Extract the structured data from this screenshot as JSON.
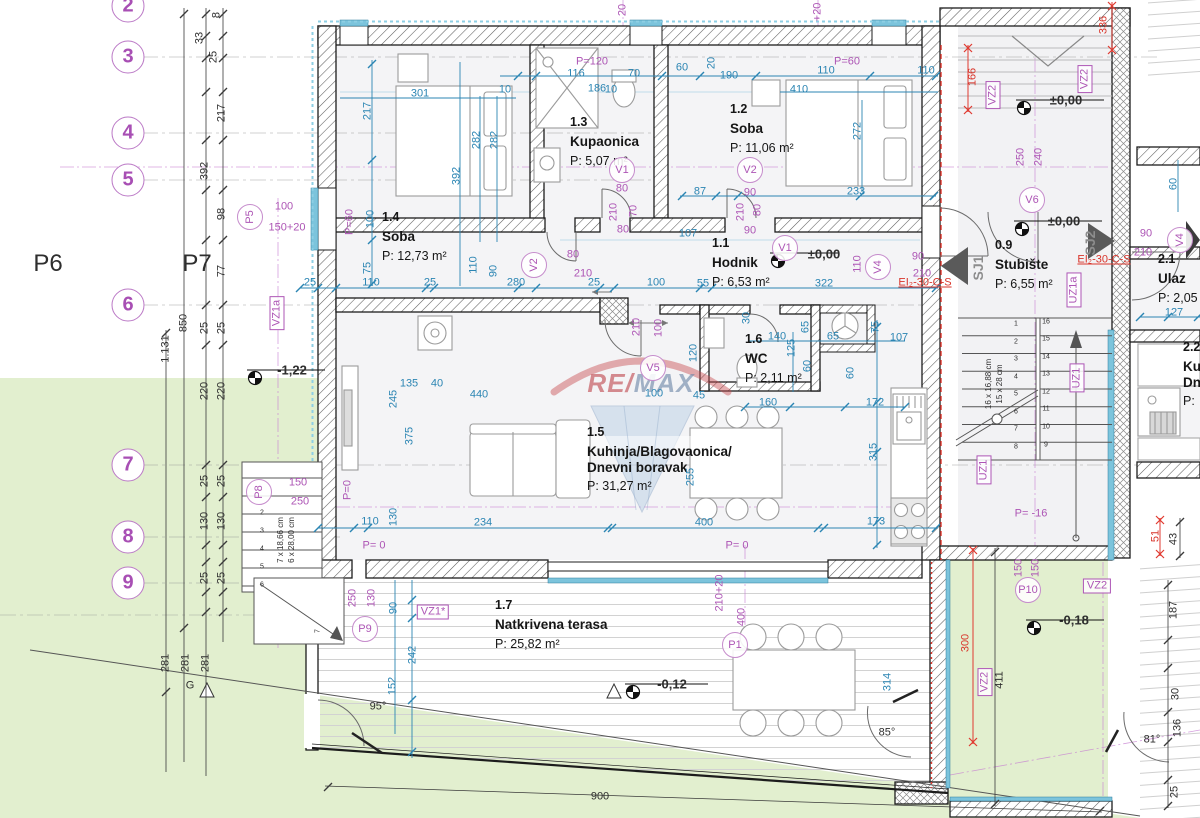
{
  "watermark": {
    "re": "RE",
    "slash": "/",
    "max": "MAX"
  },
  "grid": {
    "rows": [
      {
        "n": "2",
        "y": 6
      },
      {
        "n": "3",
        "y": 57
      },
      {
        "n": "4",
        "y": 133
      },
      {
        "n": "5",
        "y": 180
      },
      {
        "n": "6",
        "y": 305
      },
      {
        "n": "7",
        "y": 465
      },
      {
        "n": "8",
        "y": 537
      },
      {
        "n": "9",
        "y": 583
      }
    ],
    "plan_labels": [
      {
        "t": "P6",
        "x": 48,
        "y": 264
      },
      {
        "t": "P7",
        "x": 197,
        "y": 264
      }
    ]
  },
  "rooms": [
    {
      "id": "1.4",
      "lines": [
        "Soba"
      ],
      "area": "P: 12,73 m²",
      "x": 382,
      "y": 210
    },
    {
      "id": "1.3",
      "lines": [
        "Kupaonica"
      ],
      "area": "P: 5,07 m²",
      "x": 570,
      "y": 115
    },
    {
      "id": "1.2",
      "lines": [
        "Soba"
      ],
      "area": "P: 11,06 m²",
      "x": 730,
      "y": 102
    },
    {
      "id": "1.1",
      "lines": [
        "Hodnik"
      ],
      "area": "P: 6,53 m²",
      "x": 712,
      "y": 236
    },
    {
      "id": "1.6",
      "lines": [
        "WC"
      ],
      "area": "P: 2,11 m²",
      "x": 745,
      "y": 332
    },
    {
      "id": "1.5",
      "lines": [
        "Kuhinja/Blagovaonica/",
        "Dnevni boravak"
      ],
      "area": "P: 31,27 m²",
      "x": 587,
      "y": 425
    },
    {
      "id": "1.7",
      "lines": [
        "Natkrivena terasa"
      ],
      "area": "P: 25,82 m²",
      "x": 495,
      "y": 598
    },
    {
      "id": "0.9",
      "lines": [
        "Stubište"
      ],
      "area": "P: 6,55 m²",
      "x": 995,
      "y": 238
    },
    {
      "id": "2.1",
      "lines": [
        "Ulaz"
      ],
      "area": "P: 2,05",
      "x": 1158,
      "y": 252
    },
    {
      "id": "2.2",
      "lines": [
        "Ku",
        "Dn"
      ],
      "area": "P:",
      "x": 1183,
      "y": 340
    }
  ],
  "levels": [
    {
      "t": "±0,00",
      "x": 824,
      "y": 254
    },
    {
      "t": "±0,00",
      "x": 1066,
      "y": 100
    },
    {
      "t": "±0,00",
      "x": 1064,
      "y": 221
    },
    {
      "t": "-1,22",
      "x": 292,
      "y": 370
    },
    {
      "t": "-0,12",
      "x": 672,
      "y": 684
    },
    {
      "t": "-0,18",
      "x": 1074,
      "y": 620
    }
  ],
  "annotations": [
    {
      "t": "301",
      "x": 420,
      "y": 94
    },
    {
      "t": "217",
      "x": 368,
      "y": 111,
      "v": 1
    },
    {
      "t": "282",
      "x": 477,
      "y": 140,
      "v": 1
    },
    {
      "t": "282",
      "x": 495,
      "y": 140,
      "v": 1
    },
    {
      "t": "392",
      "x": 457,
      "y": 176,
      "v": 1
    },
    {
      "t": "100",
      "x": 371,
      "y": 219,
      "v": 1
    },
    {
      "t": "75",
      "x": 368,
      "y": 268,
      "v": 1
    },
    {
      "t": "110",
      "x": 474,
      "y": 265,
      "v": 1
    },
    {
      "t": "90",
      "x": 494,
      "y": 271,
      "v": 1
    },
    {
      "t": "116",
      "x": 576,
      "y": 74
    },
    {
      "t": "186",
      "x": 597,
      "y": 89
    },
    {
      "t": "70",
      "x": 634,
      "y": 74
    },
    {
      "t": "10",
      "x": 505,
      "y": 90
    },
    {
      "t": "10",
      "x": 611,
      "y": 90
    },
    {
      "t": "60",
      "x": 682,
      "y": 68
    },
    {
      "t": "20",
      "x": 712,
      "y": 63,
      "v": 1
    },
    {
      "t": "190",
      "x": 729,
      "y": 76
    },
    {
      "t": "110",
      "x": 826,
      "y": 71
    },
    {
      "t": "110",
      "x": 926,
      "y": 71
    },
    {
      "t": "410",
      "x": 799,
      "y": 90
    },
    {
      "t": "272",
      "x": 858,
      "y": 131,
      "v": 1
    },
    {
      "t": "233",
      "x": 856,
      "y": 192
    },
    {
      "t": "87",
      "x": 700,
      "y": 192
    },
    {
      "t": "107",
      "x": 688,
      "y": 234
    },
    {
      "t": "25",
      "x": 310,
      "y": 283
    },
    {
      "t": "110",
      "x": 371,
      "y": 283
    },
    {
      "t": "25",
      "x": 430,
      "y": 283
    },
    {
      "t": "280",
      "x": 516,
      "y": 283
    },
    {
      "t": "25",
      "x": 594,
      "y": 283
    },
    {
      "t": "100",
      "x": 656,
      "y": 283
    },
    {
      "t": "55",
      "x": 703,
      "y": 284
    },
    {
      "t": "322",
      "x": 824,
      "y": 284
    },
    {
      "t": "30",
      "x": 747,
      "y": 318,
      "v": 1
    },
    {
      "t": "140",
      "x": 777,
      "y": 337
    },
    {
      "t": "65",
      "x": 806,
      "y": 327,
      "v": 1
    },
    {
      "t": "65",
      "x": 833,
      "y": 337
    },
    {
      "t": "125",
      "x": 792,
      "y": 348,
      "v": 1
    },
    {
      "t": "60",
      "x": 808,
      "y": 366,
      "v": 1
    },
    {
      "t": "60",
      "x": 851,
      "y": 373,
      "v": 1
    },
    {
      "t": "120",
      "x": 694,
      "y": 353,
      "v": 1
    },
    {
      "t": "160",
      "x": 768,
      "y": 403
    },
    {
      "t": "172",
      "x": 875,
      "y": 403
    },
    {
      "t": "107",
      "x": 899,
      "y": 338
    },
    {
      "t": "75",
      "x": 876,
      "y": 327,
      "v": 1
    },
    {
      "t": "100",
      "x": 654,
      "y": 394
    },
    {
      "t": "45",
      "x": 699,
      "y": 396
    },
    {
      "t": "135",
      "x": 409,
      "y": 384
    },
    {
      "t": "40",
      "x": 437,
      "y": 384
    },
    {
      "t": "440",
      "x": 479,
      "y": 395
    },
    {
      "t": "245",
      "x": 394,
      "y": 399,
      "v": 1
    },
    {
      "t": "375",
      "x": 410,
      "y": 436,
      "v": 1
    },
    {
      "t": "110",
      "x": 370,
      "y": 522
    },
    {
      "t": "130",
      "x": 394,
      "y": 517,
      "v": 1
    },
    {
      "t": "234",
      "x": 483,
      "y": 523
    },
    {
      "t": "400",
      "x": 704,
      "y": 523
    },
    {
      "t": "173",
      "x": 876,
      "y": 522
    },
    {
      "t": "315",
      "x": 874,
      "y": 452,
      "v": 1
    },
    {
      "t": "255",
      "x": 691,
      "y": 477,
      "v": 1
    },
    {
      "t": "314",
      "x": 888,
      "y": 682,
      "v": 1
    },
    {
      "t": "90",
      "x": 394,
      "y": 608,
      "v": 1
    },
    {
      "t": "242",
      "x": 413,
      "y": 655,
      "v": 1
    },
    {
      "t": "152",
      "x": 393,
      "y": 686,
      "v": 1
    },
    {
      "t": "127",
      "x": 1174,
      "y": 313
    },
    {
      "t": "60",
      "x": 1174,
      "y": 184,
      "v": 1
    },
    {
      "t": "8",
      "x": 217,
      "y": 15,
      "v": 1,
      "c": "k"
    },
    {
      "t": "33",
      "x": 200,
      "y": 38,
      "v": 1,
      "c": "k"
    },
    {
      "t": "25",
      "x": 214,
      "y": 57,
      "v": 1,
      "c": "k"
    },
    {
      "t": "217",
      "x": 222,
      "y": 113,
      "v": 1,
      "c": "k"
    },
    {
      "t": "392",
      "x": 205,
      "y": 171,
      "v": 1,
      "c": "k"
    },
    {
      "t": "98",
      "x": 222,
      "y": 214,
      "v": 1,
      "c": "k"
    },
    {
      "t": "77",
      "x": 222,
      "y": 271,
      "v": 1,
      "c": "k"
    },
    {
      "t": "850",
      "x": 184,
      "y": 323,
      "v": 1,
      "c": "k"
    },
    {
      "t": "1.131",
      "x": 166,
      "y": 349,
      "v": 1,
      "c": "k"
    },
    {
      "t": "25",
      "x": 205,
      "y": 328,
      "v": 1,
      "c": "k"
    },
    {
      "t": "25",
      "x": 222,
      "y": 328,
      "v": 1,
      "c": "k"
    },
    {
      "t": "220",
      "x": 205,
      "y": 391,
      "v": 1,
      "c": "k"
    },
    {
      "t": "220",
      "x": 222,
      "y": 391,
      "v": 1,
      "c": "k"
    },
    {
      "t": "25",
      "x": 205,
      "y": 481,
      "v": 1,
      "c": "k"
    },
    {
      "t": "25",
      "x": 222,
      "y": 481,
      "v": 1,
      "c": "k"
    },
    {
      "t": "130",
      "x": 205,
      "y": 521,
      "v": 1,
      "c": "k"
    },
    {
      "t": "130",
      "x": 222,
      "y": 521,
      "v": 1,
      "c": "k"
    },
    {
      "t": "25",
      "x": 205,
      "y": 578,
      "v": 1,
      "c": "k"
    },
    {
      "t": "25",
      "x": 222,
      "y": 578,
      "v": 1,
      "c": "k"
    },
    {
      "t": "281",
      "x": 166,
      "y": 663,
      "v": 1,
      "c": "k"
    },
    {
      "t": "281",
      "x": 186,
      "y": 663,
      "v": 1,
      "c": "k"
    },
    {
      "t": "281",
      "x": 206,
      "y": 663,
      "v": 1,
      "c": "k"
    },
    {
      "t": "G",
      "x": 190,
      "y": 686,
      "c": "k"
    },
    {
      "t": "900",
      "x": 600,
      "y": 797,
      "c": "k"
    },
    {
      "t": "43",
      "x": 1174,
      "y": 539,
      "v": 1,
      "c": "k"
    },
    {
      "t": "411",
      "x": 1000,
      "y": 680,
      "v": 1,
      "c": "k"
    },
    {
      "t": "187",
      "x": 1174,
      "y": 610,
      "v": 1,
      "c": "k"
    },
    {
      "t": "30",
      "x": 1176,
      "y": 694,
      "v": 1,
      "c": "k"
    },
    {
      "t": "136",
      "x": 1178,
      "y": 728,
      "v": 1,
      "c": "k"
    },
    {
      "t": "25",
      "x": 1175,
      "y": 792,
      "v": 1,
      "c": "k"
    },
    {
      "t": "95°",
      "x": 378,
      "y": 707,
      "c": "k"
    },
    {
      "t": "85°",
      "x": 887,
      "y": 733,
      "c": "k"
    },
    {
      "t": "81°",
      "x": 1152,
      "y": 740,
      "c": "k"
    },
    {
      "t": "16 x 16,88 cm",
      "x": 989,
      "y": 384,
      "v": 1,
      "c": "k",
      "fs": 8
    },
    {
      "t": "15 x 28 cm",
      "x": 1000,
      "y": 384,
      "v": 1,
      "c": "k",
      "fs": 8
    },
    {
      "t": "7 x 18,66 cm",
      "x": 281,
      "y": 540,
      "v": 1,
      "c": "k",
      "fs": 8
    },
    {
      "t": "6 x 28,00 cm",
      "x": 292,
      "y": 540,
      "v": 1,
      "c": "k",
      "fs": 8
    },
    {
      "t": "1",
      "x": 1016,
      "y": 324,
      "c": "k",
      "fs": 7
    },
    {
      "t": "2",
      "x": 1016,
      "y": 342,
      "c": "k",
      "fs": 7
    },
    {
      "t": "3",
      "x": 1016,
      "y": 359,
      "c": "k",
      "fs": 7
    },
    {
      "t": "4",
      "x": 1016,
      "y": 377,
      "c": "k",
      "fs": 7
    },
    {
      "t": "5",
      "x": 1016,
      "y": 394,
      "c": "k",
      "fs": 7
    },
    {
      "t": "6",
      "x": 1016,
      "y": 412,
      "c": "k",
      "fs": 7
    },
    {
      "t": "7",
      "x": 1016,
      "y": 429,
      "c": "k",
      "fs": 7
    },
    {
      "t": "8",
      "x": 1016,
      "y": 447,
      "c": "k",
      "fs": 7
    },
    {
      "t": "16",
      "x": 1046,
      "y": 322,
      "c": "k",
      "fs": 7
    },
    {
      "t": "15",
      "x": 1046,
      "y": 339,
      "c": "k",
      "fs": 7
    },
    {
      "t": "14",
      "x": 1046,
      "y": 357,
      "c": "k",
      "fs": 7
    },
    {
      "t": "13",
      "x": 1046,
      "y": 374,
      "c": "k",
      "fs": 7
    },
    {
      "t": "12",
      "x": 1046,
      "y": 392,
      "c": "k",
      "fs": 7
    },
    {
      "t": "11",
      "x": 1046,
      "y": 409,
      "c": "k",
      "fs": 7
    },
    {
      "t": "10",
      "x": 1046,
      "y": 427,
      "c": "k",
      "fs": 7
    },
    {
      "t": "9",
      "x": 1046,
      "y": 445,
      "c": "k",
      "fs": 7
    },
    {
      "t": "2",
      "x": 262,
      "y": 513,
      "c": "k",
      "fs": 7
    },
    {
      "t": "3",
      "x": 262,
      "y": 531,
      "c": "k",
      "fs": 7
    },
    {
      "t": "4",
      "x": 262,
      "y": 549,
      "c": "k",
      "fs": 7
    },
    {
      "t": "5",
      "x": 262,
      "y": 567,
      "c": "k",
      "fs": 7
    },
    {
      "t": "6",
      "x": 262,
      "y": 585,
      "c": "k",
      "fs": 7
    },
    {
      "t": "7",
      "x": 318,
      "y": 631,
      "v": 1,
      "c": "k",
      "fs": 7
    },
    {
      "t": "P=120",
      "x": 592,
      "y": 62,
      "c": "p"
    },
    {
      "t": "P=60",
      "x": 847,
      "y": 62,
      "c": "p"
    },
    {
      "t": "P=60",
      "x": 350,
      "y": 222,
      "c": "p",
      "v": 1
    },
    {
      "t": "P=0",
      "x": 348,
      "y": 490,
      "c": "p",
      "v": 1
    },
    {
      "t": "P= 0",
      "x": 374,
      "y": 546,
      "c": "p"
    },
    {
      "t": "P= 0",
      "x": 737,
      "y": 546,
      "c": "p"
    },
    {
      "t": "P= -16",
      "x": 1031,
      "y": 514,
      "c": "p"
    },
    {
      "t": "100",
      "x": 284,
      "y": 207,
      "c": "p"
    },
    {
      "t": "150+20",
      "x": 287,
      "y": 228,
      "c": "p"
    },
    {
      "t": "150",
      "x": 298,
      "y": 483,
      "c": "p"
    },
    {
      "t": "250",
      "x": 300,
      "y": 502,
      "c": "p"
    },
    {
      "t": "250",
      "x": 353,
      "y": 598,
      "c": "p",
      "v": 1
    },
    {
      "t": "130",
      "x": 372,
      "y": 598,
      "c": "p",
      "v": 1
    },
    {
      "t": "150",
      "x": 1019,
      "y": 568,
      "c": "p",
      "v": 1
    },
    {
      "t": "150",
      "x": 1036,
      "y": 568,
      "c": "p",
      "v": 1
    },
    {
      "t": "210+20",
      "x": 720,
      "y": 593,
      "c": "p",
      "v": 1
    },
    {
      "t": "400",
      "x": 742,
      "y": 617,
      "c": "p",
      "v": 1
    },
    {
      "t": "80",
      "x": 573,
      "y": 255,
      "c": "p"
    },
    {
      "t": "210",
      "x": 583,
      "y": 274,
      "c": "p"
    },
    {
      "t": "80",
      "x": 622,
      "y": 189,
      "c": "p"
    },
    {
      "t": "210",
      "x": 614,
      "y": 212,
      "c": "p",
      "v": 1
    },
    {
      "t": "70",
      "x": 634,
      "y": 211,
      "c": "p",
      "v": 1
    },
    {
      "t": "80",
      "x": 623,
      "y": 230,
      "c": "p"
    },
    {
      "t": "90",
      "x": 750,
      "y": 193,
      "c": "p"
    },
    {
      "t": "210",
      "x": 741,
      "y": 212,
      "c": "p",
      "v": 1
    },
    {
      "t": "80",
      "x": 758,
      "y": 210,
      "c": "p",
      "v": 1
    },
    {
      "t": "90",
      "x": 750,
      "y": 231,
      "c": "p"
    },
    {
      "t": "90",
      "x": 918,
      "y": 257,
      "c": "p"
    },
    {
      "t": "210",
      "x": 922,
      "y": 274,
      "c": "p"
    },
    {
      "t": "90",
      "x": 1146,
      "y": 234,
      "c": "p"
    },
    {
      "t": "210",
      "x": 1143,
      "y": 253,
      "c": "p"
    },
    {
      "t": "250",
      "x": 1021,
      "y": 157,
      "c": "p",
      "v": 1
    },
    {
      "t": "240",
      "x": 1039,
      "y": 157,
      "c": "p",
      "v": 1
    },
    {
      "t": "210",
      "x": 637,
      "y": 327,
      "c": "p",
      "v": 1
    },
    {
      "t": "100",
      "x": 659,
      "y": 328,
      "c": "p",
      "v": 1
    },
    {
      "t": "110",
      "x": 858,
      "y": 264,
      "c": "p",
      "v": 1
    },
    {
      "t": "20",
      "x": 623,
      "y": 10,
      "c": "p",
      "v": 1
    },
    {
      "t": "+20",
      "x": 818,
      "y": 12,
      "c": "p",
      "v": 1
    },
    {
      "t": "VZ1a",
      "x": 277,
      "y": 313,
      "c": "p",
      "v": 1,
      "box": 1
    },
    {
      "t": "VZ1*",
      "x": 433,
      "y": 612,
      "c": "p",
      "box": 1
    },
    {
      "t": "VZ2",
      "x": 993,
      "y": 95,
      "c": "p",
      "v": 1,
      "box": 1
    },
    {
      "t": "VZ2",
      "x": 1085,
      "y": 79,
      "c": "p",
      "v": 1,
      "box": 1
    },
    {
      "t": "VZ2",
      "x": 1097,
      "y": 586,
      "c": "p",
      "box": 1
    },
    {
      "t": "VZ2",
      "x": 985,
      "y": 682,
      "c": "p",
      "v": 1,
      "box": 1
    },
    {
      "t": "UZ1",
      "x": 984,
      "y": 470,
      "c": "p",
      "v": 1,
      "box": 1
    },
    {
      "t": "UZ1",
      "x": 1077,
      "y": 378,
      "c": "p",
      "v": 1,
      "box": 1
    },
    {
      "t": "UZ1a",
      "x": 1074,
      "y": 290,
      "c": "p",
      "v": 1,
      "box": 1
    },
    {
      "t": "P5",
      "x": 250,
      "y": 217,
      "c": "p",
      "circ": 1,
      "v": 1
    },
    {
      "t": "P8",
      "x": 259,
      "y": 492,
      "c": "p",
      "circ": 1,
      "v": 1
    },
    {
      "t": "P9",
      "x": 365,
      "y": 629,
      "c": "p",
      "circ": 1
    },
    {
      "t": "P10",
      "x": 1028,
      "y": 590,
      "c": "p",
      "circ": 1
    },
    {
      "t": "P1",
      "x": 735,
      "y": 645,
      "c": "p",
      "circ": 1
    },
    {
      "t": "V1",
      "x": 622,
      "y": 170,
      "c": "p",
      "circ": 1
    },
    {
      "t": "V2",
      "x": 534,
      "y": 265,
      "c": "p",
      "circ": 1,
      "v": 1
    },
    {
      "t": "V2",
      "x": 750,
      "y": 170,
      "c": "p",
      "circ": 1
    },
    {
      "t": "V1",
      "x": 785,
      "y": 248,
      "c": "p",
      "circ": 1
    },
    {
      "t": "V4",
      "x": 878,
      "y": 267,
      "c": "p",
      "circ": 1,
      "v": 1
    },
    {
      "t": "V4",
      "x": 1180,
      "y": 240,
      "c": "p",
      "circ": 1,
      "v": 1
    },
    {
      "t": "V5",
      "x": 653,
      "y": 368,
      "c": "p",
      "circ": 1
    },
    {
      "t": "V6",
      "x": 1032,
      "y": 200,
      "c": "p",
      "circ": 1
    },
    {
      "t": "EI₂-30-C-S",
      "x": 925,
      "y": 283,
      "c": "r",
      "u": 1
    },
    {
      "t": "EI₂-30-C-S",
      "x": 1104,
      "y": 260,
      "c": "r",
      "u": 1
    },
    {
      "t": "166",
      "x": 973,
      "y": 77,
      "c": "r",
      "v": 1
    },
    {
      "t": "336",
      "x": 1104,
      "y": 25,
      "c": "r",
      "v": 1
    },
    {
      "t": "300",
      "x": 966,
      "y": 643,
      "c": "r",
      "v": 1
    },
    {
      "t": "51",
      "x": 1156,
      "y": 536,
      "c": "r",
      "v": 1
    },
    {
      "t": "SJ1",
      "x": 978,
      "y": 268,
      "c": "g",
      "v": 1,
      "fs": 14
    },
    {
      "t": "SJ2",
      "x": 1090,
      "y": 243,
      "c": "g",
      "v": 1,
      "fs": 14
    }
  ],
  "colors": {
    "dim_blue": "#2b85b3",
    "purple": "#ad55b5",
    "red": "#d9352b",
    "green_area": "#e2efcf",
    "teal_window": "#7cc4dc",
    "wall": "#1c1c1c"
  }
}
